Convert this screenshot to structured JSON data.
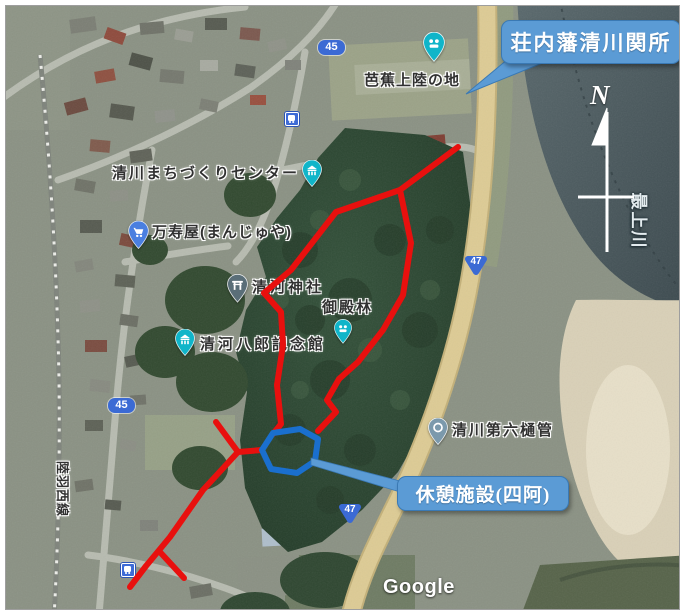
{
  "annotations": {
    "checkpoint_callout": {
      "text": "荘内藩清川関所"
    },
    "rest_facility_callout": {
      "text": "休憩施設(四阿)"
    },
    "compass_north": "N"
  },
  "map": {
    "poi_labels": {
      "basho_landing": "芭蕉上陸の地",
      "machizukuri_center": "清川まちづくりセンター",
      "manjuya": "万寿屋(まんじゅや)",
      "kiyokawa_shrine": "清河神社",
      "gotenbayashi": "御殿林",
      "hachiro_museum": "清河八郎記念館",
      "dairoku_sluice": "清川第六樋管",
      "mogami_river": "最上川",
      "rikuu_west_line": "陸羽西線"
    },
    "route_shields": {
      "route45": "45",
      "route47": "47"
    },
    "brand_logo": "Google"
  },
  "colors": {
    "callout_blue": "#5B9BD5",
    "trail_red": "#E8100E",
    "octagon_blue": "#1A6FCE",
    "pin_teal": "#10B5C9",
    "pin_blue": "#4A7FE0",
    "pin_slate": "#5A6E78",
    "pin_steel": "#7B99AC",
    "shield_blue": "#3B6AD4",
    "road47_tan": "#D9C88F",
    "water_grey": "#47565C"
  }
}
